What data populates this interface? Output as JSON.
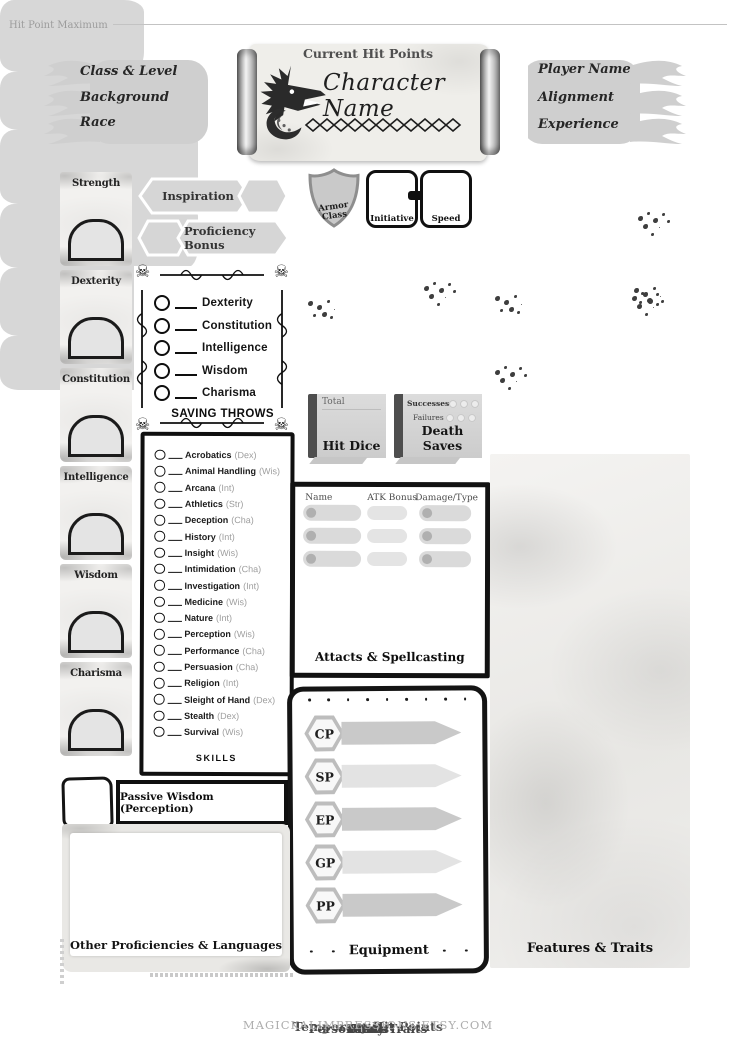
{
  "header": {
    "left_banner": {
      "class_level": "Class & Level",
      "background": "Background",
      "race": "Race"
    },
    "scroll_title": "Character Name",
    "right_banner": {
      "player_name": "Player Name",
      "alignment": "Alignment",
      "experience": "Experience"
    }
  },
  "abilities": [
    "Strength",
    "Dexterity",
    "Constitution",
    "Intelligence",
    "Wisdom",
    "Charisma"
  ],
  "banners": {
    "inspiration": "Inspiration",
    "proficiency_bonus": "Proficiency Bonus"
  },
  "saving_throws": {
    "items": [
      "Dexterity",
      "Constitution",
      "Intelligence",
      "Wisdom",
      "Charisma"
    ],
    "label": "SAVING THROWS"
  },
  "skills": {
    "label": "SKILLS",
    "items": [
      {
        "name": "Acrobatics",
        "abil": "(Dex)"
      },
      {
        "name": "Animal Handling",
        "abil": "(Wis)"
      },
      {
        "name": "Arcana",
        "abil": "(Int)"
      },
      {
        "name": "Athletics",
        "abil": "(Str)"
      },
      {
        "name": "Deception",
        "abil": "(Cha)"
      },
      {
        "name": "History",
        "abil": "(Int)"
      },
      {
        "name": "Insight",
        "abil": "(Wis)"
      },
      {
        "name": "Intimidation",
        "abil": "(Cha)"
      },
      {
        "name": "Investigation",
        "abil": "(Int)"
      },
      {
        "name": "Medicine",
        "abil": "(Wis)"
      },
      {
        "name": "Nature",
        "abil": "(Int)"
      },
      {
        "name": "Perception",
        "abil": "(Wis)"
      },
      {
        "name": "Performance",
        "abil": "(Cha)"
      },
      {
        "name": "Persuasion",
        "abil": "(Cha)"
      },
      {
        "name": "Religion",
        "abil": "(Int)"
      },
      {
        "name": "Sleight of Hand",
        "abil": "(Dex)"
      },
      {
        "name": "Stealth",
        "abil": "(Dex)"
      },
      {
        "name": "Survival",
        "abil": "(Wis)"
      }
    ]
  },
  "combat": {
    "armor_class": "Armor Class",
    "initiative": "Initiative",
    "speed": "Speed",
    "hit_point_maximum": "Hit Point Maximum",
    "current_hit_points": "Current Hit Points",
    "temporary_hit_points": "Temporary Hit Points",
    "hit_dice": {
      "total": "Total",
      "label": "Hit Dice"
    },
    "death_saves": {
      "successes": "Successes",
      "failures": "Failures",
      "label": "Death Saves"
    }
  },
  "attacks": {
    "headers": {
      "name": "Name",
      "atk_bonus": "ATK Bonus",
      "damage_type": "Damage/Type"
    },
    "label": "Attacts & Spellcasting"
  },
  "equipment": {
    "coins": [
      "CP",
      "SP",
      "EP",
      "GP",
      "PP"
    ],
    "label": "Equipment"
  },
  "personality": {
    "traits": "Personality Traits",
    "ideals": "Ideals",
    "bonds": "Bonds",
    "flaws": "Flaws"
  },
  "features_label": "Features & Traits",
  "passive_label": "Passive Wisdom (Perception)",
  "other_proficiencies_label": "Other Proficiencies & Languages",
  "icons": {
    "skull_glyph": "☠"
  },
  "colors": {
    "ink": "#111111",
    "panel_gray": "#d7d7d7",
    "banner_gray": "#cfcfcf",
    "muted": "#9c9c9c",
    "watermark": "#adadad"
  },
  "footer": "MAGICKALIMPRESSIONS.ETSY.COM"
}
